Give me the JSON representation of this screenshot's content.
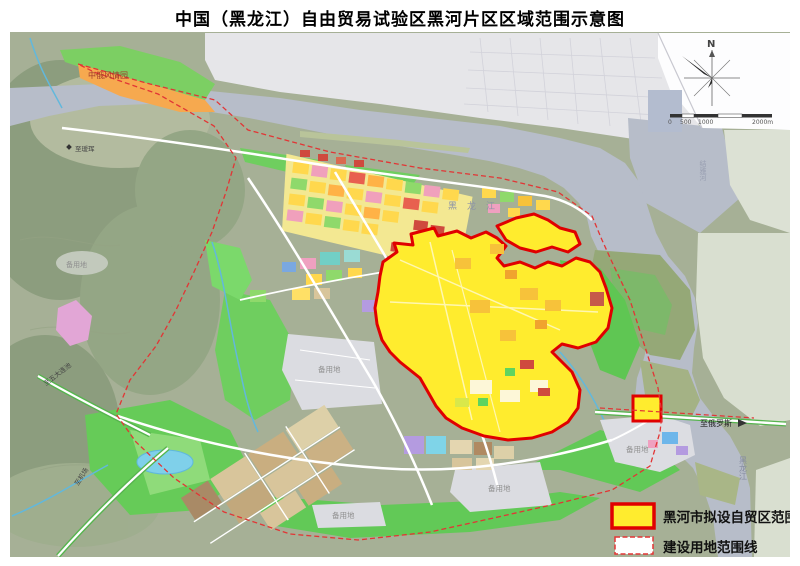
{
  "title": "中国（黑龙江）自由贸易试验区黑河片区区域范围示意图",
  "compass": {
    "north": "N"
  },
  "scale_bar": {
    "ticks": [
      "0",
      "500",
      "1000",
      "2000m"
    ]
  },
  "legend": {
    "items": [
      {
        "label": "黑河市拟设自贸区范围",
        "swatch_fill": "#ffec2e",
        "swatch_border": "#e00000",
        "border_style": "solid"
      },
      {
        "label": "建设用地范围线",
        "swatch_fill": "#ffffff",
        "swatch_border": "#e23535",
        "border_style": "dashed"
      }
    ]
  },
  "labels": {
    "theme_park": "中俄风情园",
    "river_top": "黑龙江",
    "river_ne_vertical": "结雅河",
    "river_se_vertical": "黑龙江",
    "to_russia": "至俄罗斯",
    "reserve_land": "备用地",
    "road_to_aihui": "至瑷珲",
    "road_to_wudalianchi": "至五大连池",
    "road_to_airport": "至机场"
  },
  "colors": {
    "ftz_fill": "#ffec2e",
    "ftz_border": "#e00000",
    "construction_line": "#e23535",
    "river": "#b7bdc9",
    "russian_city": "#e6e6e9",
    "hills": "#a6b096",
    "park_green": "#62c957",
    "theme_park_orange": "#f6a94f"
  }
}
